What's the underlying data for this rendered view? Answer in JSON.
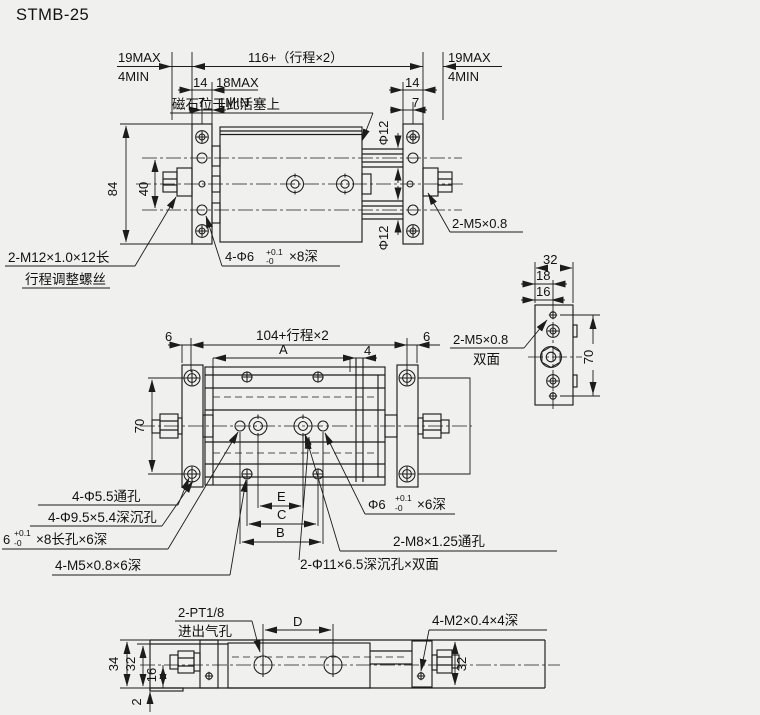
{
  "title": "STMB-25",
  "colors": {
    "background": "#f0f0ee",
    "line": "#1c1c1c",
    "text": "#111111"
  },
  "front_view": {
    "dims": {
      "d19max_left": "19MAX",
      "d4min_left": "4MIN",
      "d14_left": "14",
      "d7_left": "7",
      "d18max": "18MAX",
      "d1min": "1MIN",
      "d116": "116+（行程×2）",
      "d19max_right": "19MAX",
      "d4min_right": "4MIN",
      "d14_right": "14",
      "d7_right": "7",
      "d84": "84",
      "d40": "40",
      "dphi12_top": "Φ12",
      "dphi12_bottom": "Φ12"
    },
    "notes": {
      "magnet": "磁石位于此活塞上",
      "m12_line1": "2-M12×1.0×12长",
      "m12_line2": "行程调整螺丝",
      "phi6_prefix": "4-Φ6",
      "phi6_tol_top": "+0.1",
      "phi6_tol_bot": "-0",
      "phi6_suffix": "×8深",
      "m5": "2-M5×0.8"
    }
  },
  "plan_view": {
    "dims": {
      "d6_left": "6",
      "d104": "104+行程×2",
      "dA": "A",
      "d4": "4",
      "d6_right": "6",
      "d70": "70",
      "dE": "E",
      "dC": "C",
      "dB": "B"
    },
    "notes": {
      "phi55": "4-Φ5.5通孔",
      "phi95": "4-Φ9.5×5.4深沉孔",
      "slot_prefix": "6",
      "slot_tol_top": "+0.1",
      "slot_tol_bot": "-0",
      "slot_suffix": "×8长孔×6深",
      "m5": "4-M5×0.8×6深",
      "phi6_prefix": "Φ6",
      "phi6_tol_top": "+0.1",
      "phi6_tol_bot": "-0",
      "phi6_suffix": "×6深",
      "m8": "2-M8×1.25通孔",
      "phi11": "2-Φ11×6.5深沉孔×双面"
    }
  },
  "side_view": {
    "dims": {
      "d32": "32",
      "d18": "18",
      "d16": "16",
      "d70": "70"
    },
    "notes": {
      "m5": "2-M5×0.8",
      "both_sides": "双面"
    }
  },
  "bottom_view": {
    "dims": {
      "d34": "34",
      "d32_left": "32",
      "d16": "16",
      "d2": "2",
      "dD": "D",
      "d32_right": "32"
    },
    "notes": {
      "pt_line1": "2-PT1/8",
      "pt_line2": "进出气孔",
      "m2": "4-M2×0.4×4深"
    }
  }
}
